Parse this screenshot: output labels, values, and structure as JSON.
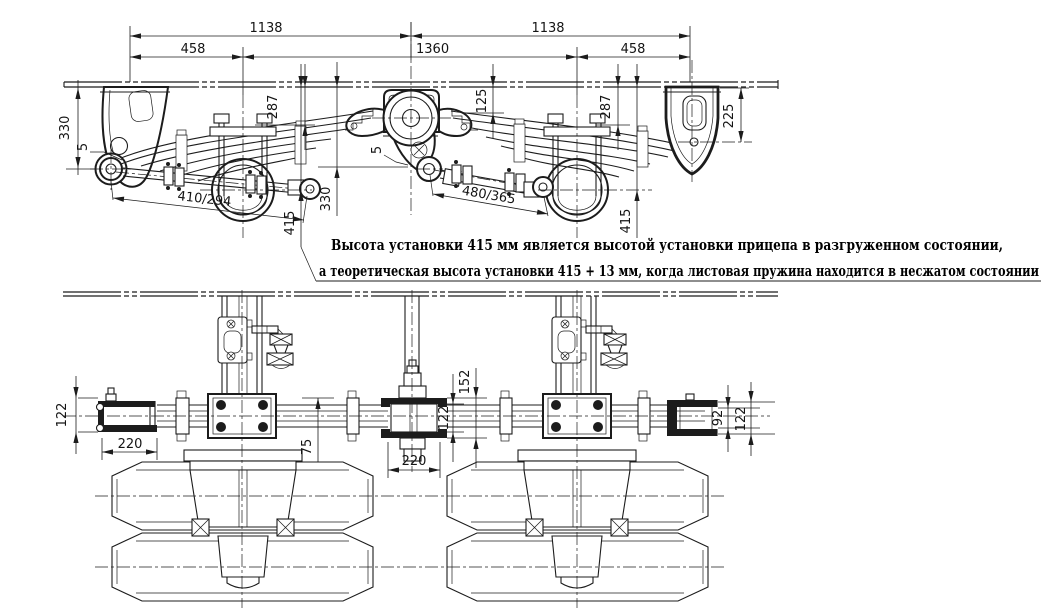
{
  "note": {
    "line1": "Высота установки 415 мм является высотой установки прицепа в разгруженном состоянии,",
    "line2": "а теоретическая высота установки 415 + 13 мм, когда листовая пружина находится в несжатом состоянии"
  },
  "side_view": {
    "dims": {
      "span_front": "1138",
      "span_rear": "1138",
      "front_hanger_to_axle": "458",
      "axle_spacing": "1360",
      "axle_to_rear_hanger": "458",
      "front_hanger_height": "330",
      "front_clearance": "5",
      "front_torque_arm": "410/294",
      "front_seat_height": "287",
      "frame_to_spring_eye": "330",
      "ride_height_front": "415",
      "equalizer_drop": "125",
      "equalizer_clearance": "5",
      "rear_torque_arm": "480/365",
      "rear_seat_height": "287",
      "ride_height_rear": "415",
      "rear_hanger_height": "225"
    }
  },
  "bottom_view": {
    "dims": {
      "front_hanger_width": "122",
      "front_hanger_length": "220",
      "spring_offset": "75",
      "equalizer_width": "122",
      "equalizer_seat_width": "152",
      "equalizer_length": "220",
      "rear_hanger_inner_width": "92",
      "rear_hanger_outer_width": "122"
    }
  }
}
